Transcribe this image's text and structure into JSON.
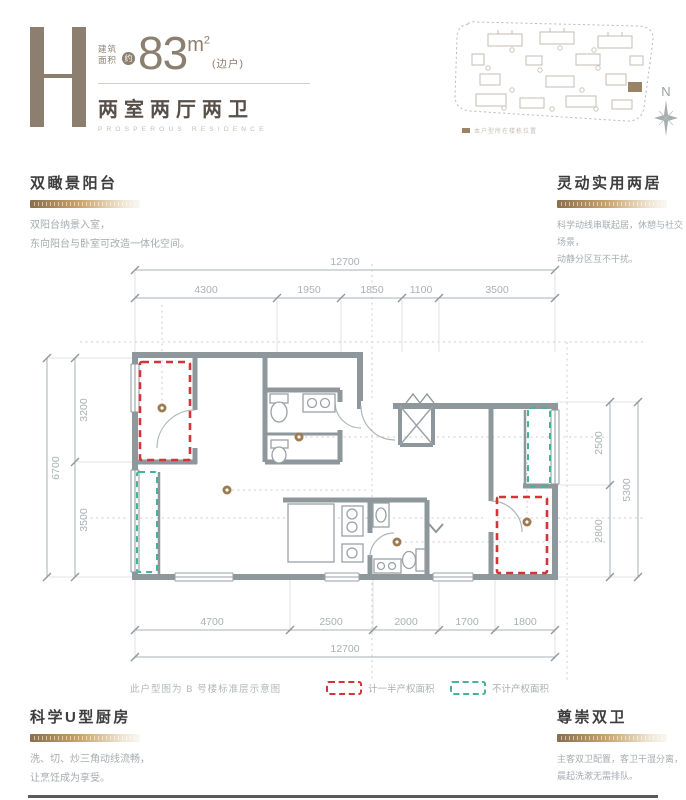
{
  "header": {
    "plan_letter": "H",
    "area_label_1": "建筑",
    "area_label_2": "面积",
    "area_approx": "约",
    "area_value": "83",
    "area_unit": "m",
    "area_unit_sup": "2",
    "area_note": "(边户)",
    "layout_title": "两室两厅两卫",
    "layout_subtitle": "PROSPEROUS RESIDENCE"
  },
  "siteplan": {
    "legend_label": "本户型所在楼栋位置",
    "north_label": "N"
  },
  "features": {
    "balcony": {
      "title": "双瞰景阳台",
      "line1": "双阳台纳景入室，",
      "line2": "东向阳台与卧室可改造一体化空间。"
    },
    "two_rooms": {
      "title": "灵动实用两居",
      "line1": "科学动线串联起居，休憩与社交场景，",
      "line2": "动静分区互不干扰。"
    },
    "kitchen": {
      "title": "科学U型厨房",
      "line1": "洗、切、炒三角动线流畅，",
      "line2": "让烹饪成为享受。"
    },
    "bathrooms": {
      "title": "尊崇双卫",
      "line1": "主客双卫配置，客卫干湿分离，",
      "line2": "晨起洗漱无需排队。"
    }
  },
  "plan": {
    "note": "此户型图为 B 号楼标准层示意图",
    "legend_half": "计一半产权面积",
    "legend_excluded": "不计产权面积",
    "dims": {
      "top_total": "12700",
      "top_segments": [
        "4300",
        "1950",
        "1850",
        "1100",
        "3500"
      ],
      "bottom_segments": [
        "4700",
        "2500",
        "2000",
        "1700",
        "1800"
      ],
      "bottom_total": "12700",
      "left_total": "6700",
      "left_segments": [
        "3200",
        "3500"
      ],
      "right_segments": [
        "2500",
        "2800"
      ],
      "right_total": "5300"
    }
  },
  "colors": {
    "accent_taupe": "#8d7f6f",
    "half_area_red": "#d2343a",
    "excluded_green": "#45b398",
    "wall_gray": "#8e979b"
  }
}
